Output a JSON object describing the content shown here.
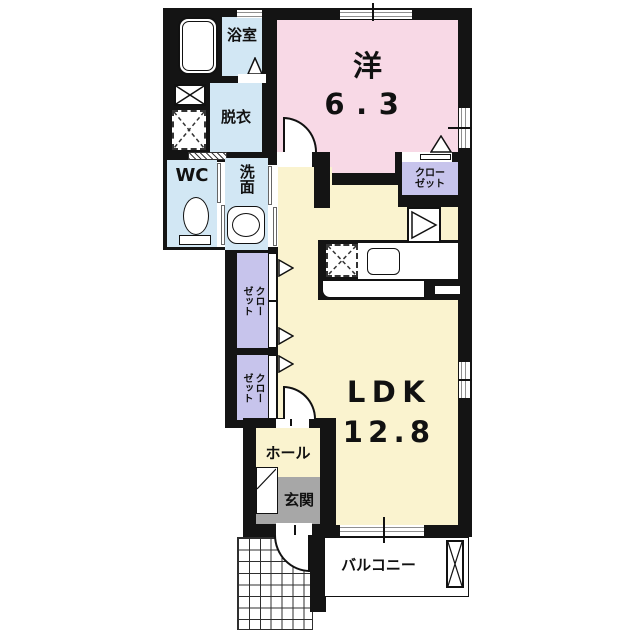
{
  "rooms": {
    "bathroom": {
      "label": "浴室"
    },
    "dressing_room": {
      "label": "脱衣"
    },
    "toilet": {
      "label": "WC"
    },
    "washroom": {
      "label": "洗面"
    },
    "western_room": {
      "label": "洋",
      "size": "6.3"
    },
    "ldk": {
      "label": "LDK",
      "size": "12.8"
    },
    "hall": {
      "label": "ホール"
    },
    "entrance": {
      "label": "玄関"
    },
    "balcony": {
      "label": "バルコニー"
    },
    "closet_bedroom": {
      "line1": "クロー",
      "line2": "ゼット"
    },
    "closet_corridor_upper": {
      "line1": "クロー",
      "line2": "ゼット"
    },
    "closet_corridor_lower": {
      "line1": "クロー",
      "line2": "ゼット"
    }
  },
  "icons": {
    "bathtub": "rounded-tub-outline",
    "vent": "x-box",
    "washing_machine": "dashed-x-box",
    "toilet": "toilet-bowl",
    "washbasin": "oval-basin",
    "kitchen_sink": "rounded-sink",
    "refrigerator": "triangle-box",
    "folding_door": "triangle",
    "door_swing": "quarter-arc",
    "porch": "tile-grid",
    "balcony_divider": "x-panel"
  },
  "colors": {
    "wall": "#141414",
    "wet_rooms": "#d2e7f4",
    "bedroom": "#f8d9e6",
    "living": "#faf3cf",
    "closet": "#c7c4ec",
    "entrance_floor": "#a7a7a7",
    "window_line": "#8f8f8f"
  }
}
